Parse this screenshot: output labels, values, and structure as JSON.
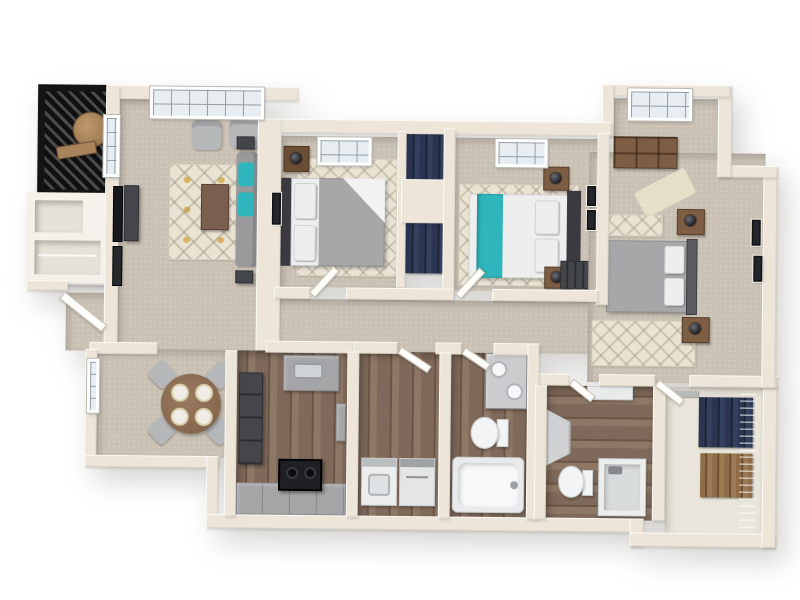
{
  "scene": {
    "description": "3D rendered floor plan of a three-bedroom, two-bathroom apartment with balcony, open living/dining area, galley kitchen, laundry room and walk-in closet",
    "view": "isometric top-down 3D render",
    "background": "#ffffff"
  },
  "palette": {
    "bg": "#ffffff",
    "wall": "#ece5d8",
    "carpet": "#c9c1b3",
    "carpetLight": "#d9d2c6",
    "wood": "#7e695a",
    "woodDark": "#6a5546",
    "woodLight": "#8d7765",
    "railing": "#141414",
    "rug": "#e9e3d4",
    "rugYellow": "#d9b35f",
    "accentTeal": "#2fb6bd",
    "sofa": "#9a9a9c",
    "chair": "#b5b7b9",
    "bedGray": "#a7a7a9",
    "bedWhite": "#eeeeee",
    "headboard": "#3a3a40",
    "woodFurn": "#7d5e45",
    "counter": "#a5a5a7",
    "cabinet": "#45464c",
    "appliance": "#1f2023",
    "fixture": "#f3f4f5",
    "clothesNavy": "#2b3552",
    "clothesTan": "#8f6c48"
  },
  "rooms": [
    {
      "id": "balcony",
      "label": "Balcony",
      "floor": "slatted deck",
      "furniture": [
        "round-patio-table",
        "bench"
      ]
    },
    {
      "id": "living-room",
      "label": "Living Room",
      "floor": "carpet",
      "furniture": [
        "sofa-with-teal-pillows",
        "coffee-table",
        "two-armchairs",
        "wall-tv",
        "media-console",
        "patterned-area-rug",
        "picture-window"
      ]
    },
    {
      "id": "dining-area",
      "label": "Dining Area",
      "floor": "carpet",
      "furniture": [
        "round-dining-table",
        "four-chairs",
        "four-place-settings",
        "window"
      ]
    },
    {
      "id": "entry",
      "label": "Entry",
      "furniture": [
        "front-door"
      ]
    },
    {
      "id": "kitchen",
      "label": "Kitchen",
      "floor": "wood",
      "furniture": [
        "tall-cabinets",
        "sink-counter",
        "range",
        "wall-oven",
        "lower-counters"
      ]
    },
    {
      "id": "laundry-room",
      "label": "Laundry Room",
      "floor": "wood",
      "furniture": [
        "washer",
        "dryer"
      ]
    },
    {
      "id": "bathroom-1",
      "label": "Bathroom 1",
      "floor": "wood",
      "furniture": [
        "double-sink-vanity",
        "toilet",
        "bathtub"
      ]
    },
    {
      "id": "bathroom-2",
      "label": "Bathroom 2",
      "floor": "wood",
      "furniture": [
        "vanity",
        "corner-shower",
        "toilet",
        "walk-in-shower"
      ]
    },
    {
      "id": "bedroom-1",
      "label": "Bedroom 1",
      "floor": "carpet",
      "furniture": [
        "bed-gray-comforter",
        "nightstand-with-lamp",
        "area-rug",
        "skylight-window",
        "wall-art"
      ]
    },
    {
      "id": "bedroom-2",
      "label": "Bedroom 2",
      "floor": "carpet",
      "furniture": [
        "bed-white-with-teal-throw",
        "two-nightstands",
        "area-rug",
        "skylight-window",
        "wall-art",
        "built-in-closet"
      ]
    },
    {
      "id": "bedroom-3",
      "label": "Bedroom 3",
      "floor": "carpet",
      "furniture": [
        "bed-gray-comforter",
        "two-nightstands-with-lamps",
        "wood-dresser",
        "window",
        "two-rugs",
        "wall-art"
      ]
    },
    {
      "id": "hall-closets",
      "label": "Hall Closets",
      "furniture": [
        "hanging-clothes"
      ]
    },
    {
      "id": "walk-in-closet",
      "label": "Walk-in Closet",
      "furniture": [
        "wire-shelving",
        "hanging-clothes"
      ]
    },
    {
      "id": "hallway",
      "label": "Hallway",
      "floor": "carpet"
    }
  ]
}
